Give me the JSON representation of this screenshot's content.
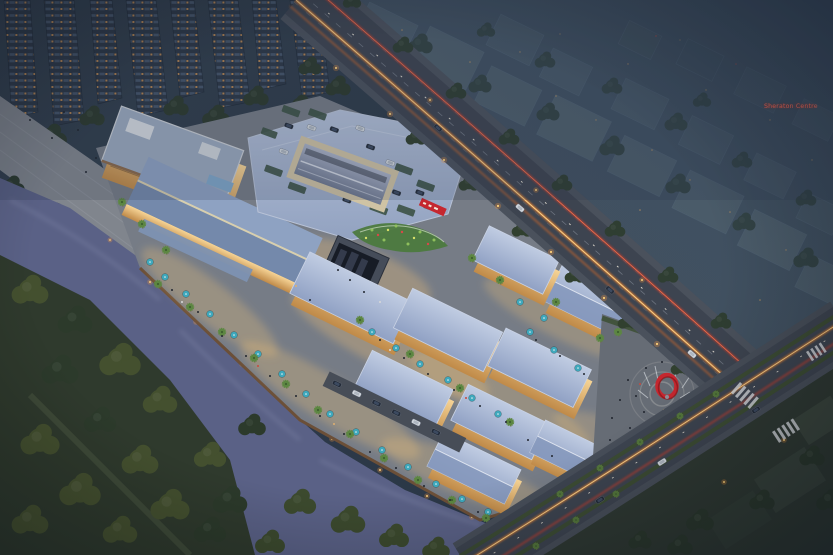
{
  "scene": {
    "title": "Aerial dusk rendering of riverside shopping mall complex",
    "time_of_day": "dusk",
    "signs": {
      "sheraton": "Sheraton Centre"
    },
    "palette": {
      "dusk_base": "#2e3b4b",
      "city_block": "#53626d",
      "city_haze": "#3c4c5e",
      "tower_facade": "#2c3746",
      "tree_dark": "#2e3c2f",
      "tree_olive": "#44502f",
      "water": "#5a6186",
      "roof_periwinkle": "#a9b8d6",
      "roof_steel": "#7f94b8",
      "deck_roof": "#9fafc9",
      "facade_warm": "#eebf7e",
      "glow_warm": "#ffd98f",
      "umbrella_teal": "#3fa8bc",
      "palm_green": "#5d8742",
      "accent_red": "#c5272f",
      "trail_orange": "#ff8a2e",
      "trail_red": "#e23c28",
      "road_asphalt": "#3e4550",
      "walkway_gray": "#82878f",
      "sign_red": "#ff6a54"
    }
  }
}
